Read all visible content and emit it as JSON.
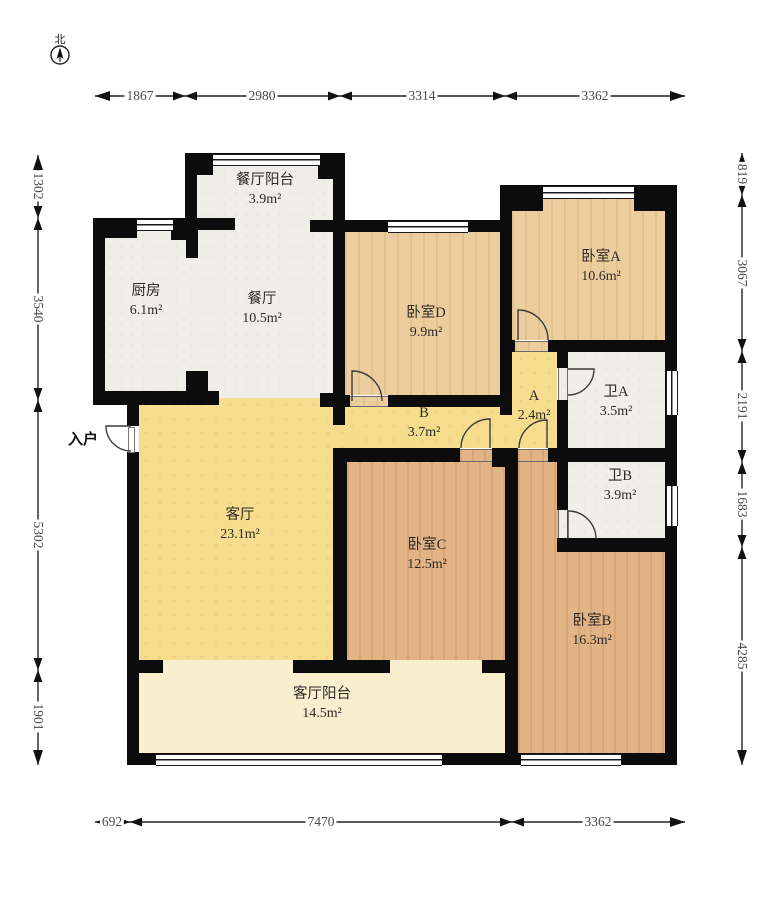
{
  "title": "户型图",
  "compass": {
    "north_label": "北"
  },
  "entrance": {
    "label": "入户"
  },
  "rooms": [
    {
      "name": "餐厅阳台",
      "area": "3.9m²"
    },
    {
      "name": "厨房",
      "area": "6.1m²"
    },
    {
      "name": "餐厅",
      "area": "10.5m²"
    },
    {
      "name": "卧室D",
      "area": "9.9m²"
    },
    {
      "name": "卧室A",
      "area": "10.6m²"
    },
    {
      "name": "A",
      "area": "2.4m²"
    },
    {
      "name": "卫A",
      "area": "3.5m²"
    },
    {
      "name": "B",
      "area": "3.7m²"
    },
    {
      "name": "卫B",
      "area": "3.9m²"
    },
    {
      "name": "客厅",
      "area": "23.1m²"
    },
    {
      "name": "卧室C",
      "area": "12.5m²"
    },
    {
      "name": "卧室B",
      "area": "16.3m²"
    },
    {
      "name": "客厅阳台",
      "area": "14.5m²"
    }
  ],
  "dims": {
    "top": [
      "1867",
      "2980",
      "3314",
      "3362"
    ],
    "bottom": [
      "692",
      "7470",
      "3362"
    ],
    "left": [
      "1302",
      "3540",
      "5302",
      "1901"
    ],
    "right": [
      "819",
      "3067",
      "2191",
      "1683",
      "4285"
    ]
  },
  "colors": {
    "wall": "#0c0c0c",
    "living_floor": "#f6dd8e",
    "bedroom_floor_light": "#ecce9e",
    "bedroom_floor_dark": "#e2b385",
    "service_floor": "#f0eee9",
    "balcony_floor": "#f7efcd"
  }
}
